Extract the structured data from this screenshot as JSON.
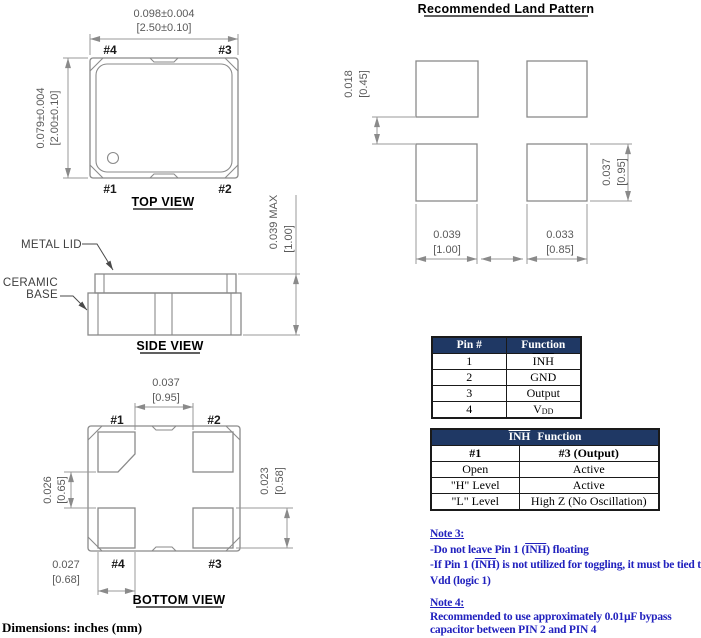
{
  "colors": {
    "table_header_bg": "#1F3864",
    "table_header_text": "#FFFFFF",
    "note_text": "#2121BE",
    "drawing_lines": "#8A8A8A",
    "dimension_text": "#5A5A5A"
  },
  "top_view": {
    "title": "TOP VIEW",
    "dims": {
      "width": {
        "in": "0.098±0.004",
        "mm": "[2.50±0.10]"
      },
      "height": {
        "in": "0.079±0.004",
        "mm": "[2.00±0.10]"
      }
    },
    "pins": {
      "top_left": "#4",
      "top_right": "#3",
      "bottom_left": "#1",
      "bottom_right": "#2"
    }
  },
  "side_view": {
    "title": "SIDE VIEW",
    "labels": {
      "lid": "METAL LID",
      "base_line1": "CERAMIC",
      "base_line2": "BASE"
    },
    "dims": {
      "height": {
        "in": "0.039 MAX",
        "mm": "[1.00]"
      }
    }
  },
  "bottom_view": {
    "title": "BOTTOM VIEW",
    "pins": {
      "top_left": "#1",
      "top_right": "#2",
      "bottom_left": "#4",
      "bottom_right": "#3"
    },
    "dims": {
      "pad_gap_horizontal": {
        "in": "0.037",
        "mm": "[0.95]"
      },
      "pad_gap_vertical": {
        "in": "0.026",
        "mm": "[0.65]"
      },
      "pad_height": {
        "in": "0.023",
        "mm": "[0.58]"
      },
      "pad_width": {
        "in": "0.027",
        "mm": "[0.68]"
      }
    }
  },
  "land_pattern": {
    "title": "Recommended Land Pattern",
    "dims": {
      "pad_gap_vertical": {
        "in": "0.018",
        "mm": "[0.45]"
      },
      "pad_height": {
        "in": "0.037",
        "mm": "[0.95]"
      },
      "pad_width_left": {
        "in": "0.039",
        "mm": "[1.00]"
      },
      "pad_width_right": {
        "in": "0.033",
        "mm": "[0.85]"
      }
    }
  },
  "pin_table": {
    "headers": {
      "pin": "Pin #",
      "function": "Function"
    },
    "rows": [
      {
        "pin": "1",
        "function": "INH"
      },
      {
        "pin": "2",
        "function": "GND"
      },
      {
        "pin": "3",
        "function": "Output"
      },
      {
        "pin": "4",
        "function": "V",
        "function_sub": "DD"
      }
    ]
  },
  "inh_table": {
    "title_inh": "INH",
    "title_rest": "Function",
    "col_headers": {
      "left": "#1",
      "right": "#3 (Output)"
    },
    "rows": [
      {
        "left": "Open",
        "right": "Active"
      },
      {
        "left": "\"H\" Level",
        "right": "Active"
      },
      {
        "left": "\"L\" Level",
        "right": "High Z (No Oscillation)"
      }
    ]
  },
  "notes": {
    "note3": {
      "title": "Note 3:",
      "line1_pre": "-Do not leave Pin 1 (",
      "line1_inh": "INH",
      "line1_post": ") floating",
      "line2_pre": "-If Pin 1 (",
      "line2_inh": "INH",
      "line2_post": ") is not utilized for toggling, it must be tied to",
      "line3": "Vdd (logic 1)"
    },
    "note4": {
      "title": "Note 4:",
      "line1": "Recommended to use approximately 0.01µF bypass",
      "line2": "capacitor between PIN 2 and PIN 4"
    }
  },
  "footer": {
    "units_note": "Dimensions: inches (mm)"
  }
}
